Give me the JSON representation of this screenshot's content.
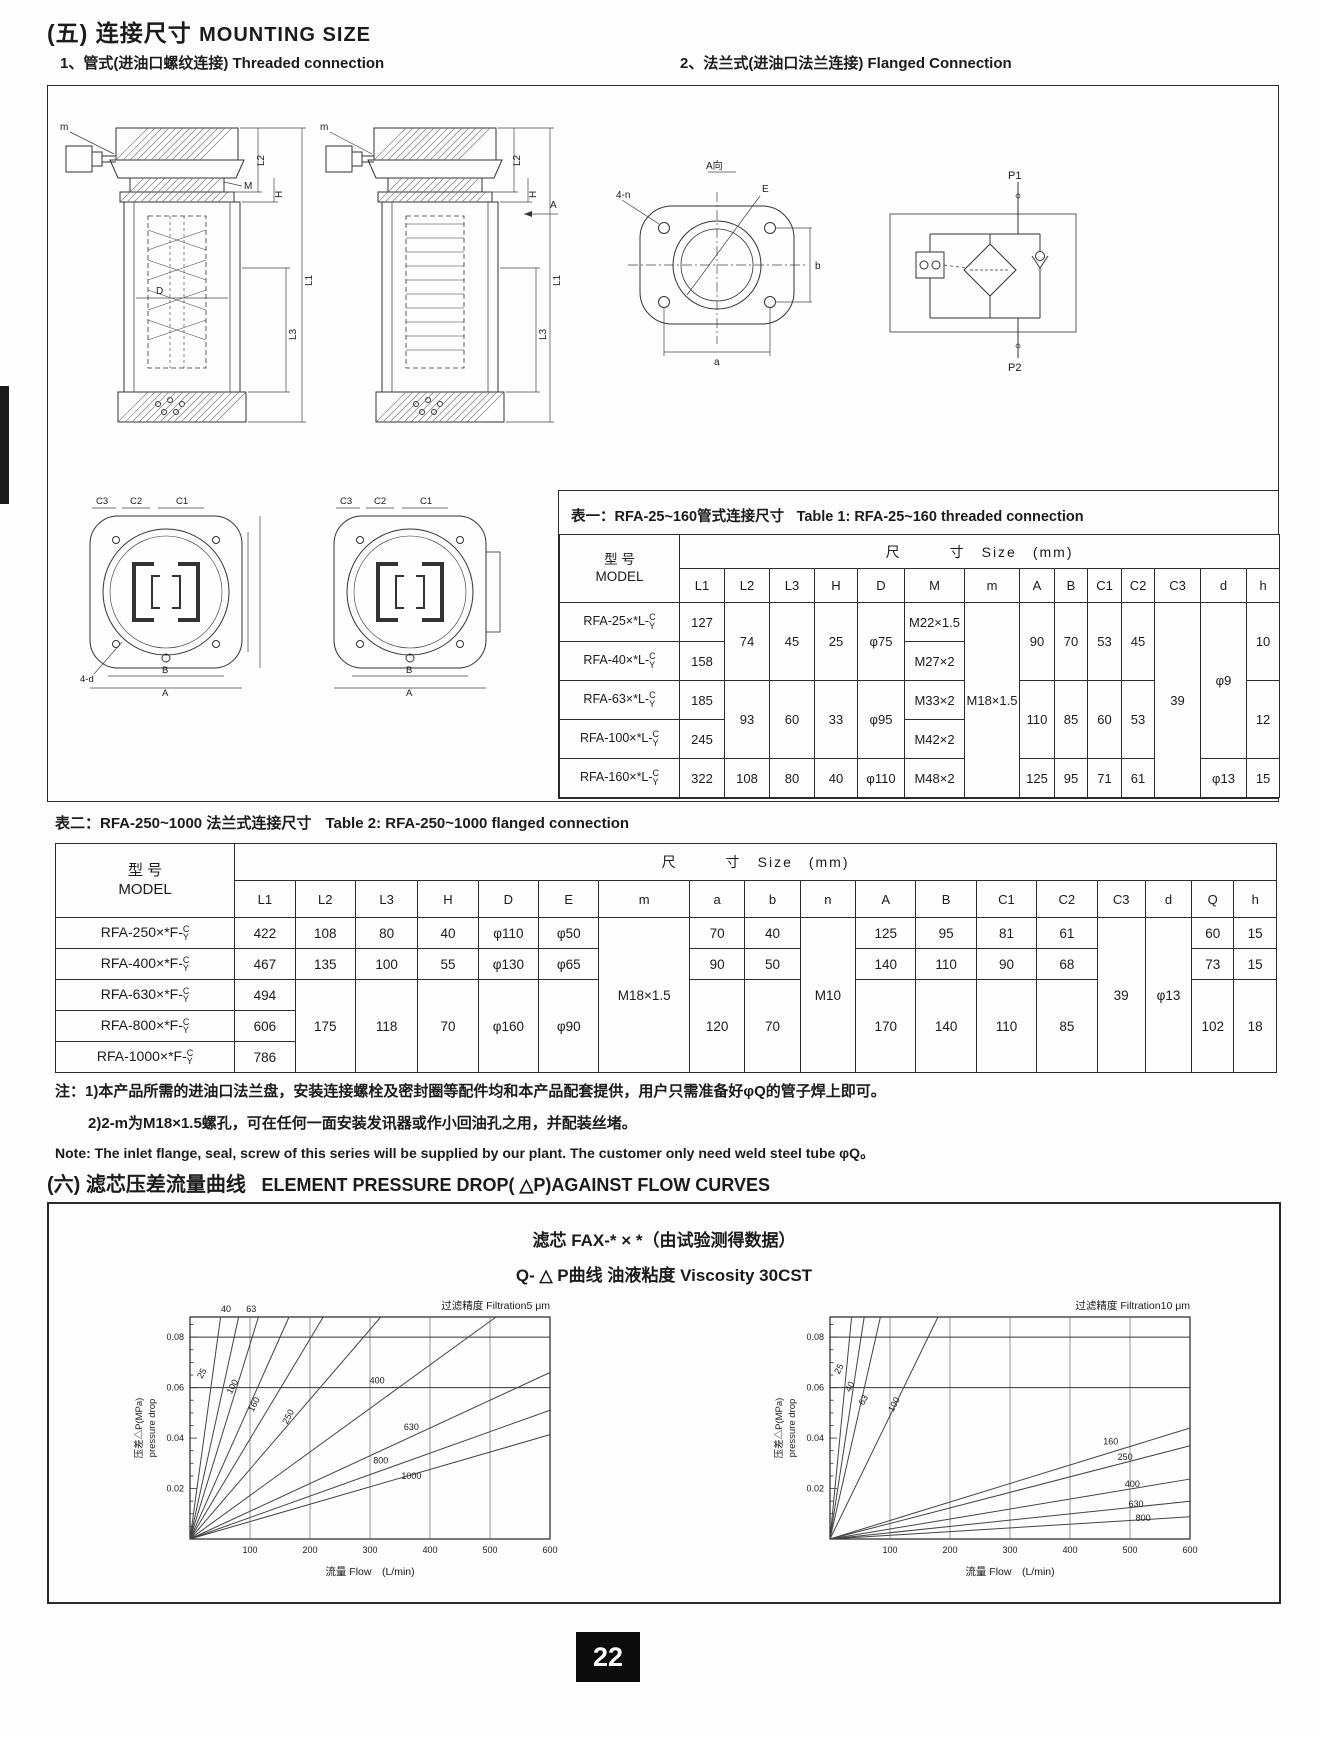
{
  "page": {
    "title_cn": "(五) 连接尺寸",
    "title_en": "MOUNTING SIZE",
    "sub1": "1、管式(进油口螺纹连接)  Threaded connection",
    "sub2": "2、法兰式(进油口法兰连接)   Flanged Connection",
    "page_number": "22"
  },
  "table1": {
    "title_cn": "表一：RFA-25~160管式连接尺寸",
    "title_en": "Table 1: RFA-25~160 threaded connection",
    "headers": {
      "model_cn": "型  号",
      "model_en": "MODEL",
      "size": "尺　　　寸　Size　(mm)",
      "cols": [
        "L1",
        "L2",
        "L3",
        "H",
        "D",
        "M",
        "m",
        "A",
        "B",
        "C1",
        "C2",
        "C3",
        "d",
        "h"
      ]
    },
    "suffix": {
      "top": "C",
      "bot": "Y"
    },
    "rows": [
      {
        "model": "RFA-25×*L-",
        "l1": "127",
        "l2": "74",
        "l3": "45",
        "h_dim": "25",
        "d": "φ75",
        "M": "M22×1.5",
        "m": "M18×1.5",
        "A": "90",
        "B": "70",
        "c1": "53",
        "c2": "45",
        "c3": "39",
        "d_small": "φ9",
        "h": "10"
      },
      {
        "model": "RFA-40×*L-",
        "l1": "158",
        "M": "M27×2"
      },
      {
        "model": "RFA-63×*L-",
        "l1": "185",
        "l2": "93",
        "l3": "60",
        "h_dim": "33",
        "d": "φ95",
        "M": "M33×2",
        "A": "110",
        "B": "85",
        "c1": "60",
        "c2": "53",
        "h": "12"
      },
      {
        "model": "RFA-100×*L-",
        "l1": "245",
        "M": "M42×2"
      },
      {
        "model": "RFA-160×*L-",
        "l1": "322",
        "l2": "108",
        "l3": "80",
        "h_dim": "40",
        "d": "φ110",
        "M": "M48×2",
        "A": "125",
        "B": "95",
        "c1": "71",
        "c2": "61",
        "d_small": "φ13",
        "h": "15"
      }
    ]
  },
  "table2": {
    "title_cn": "表二：RFA-250~1000 法兰式连接尺寸",
    "title_en": "Table 2: RFA-250~1000 flanged  connection",
    "headers": {
      "model_cn": "型  号",
      "model_en": "MODEL",
      "size": "尺　　　寸　Size　(mm)",
      "cols": [
        "L1",
        "L2",
        "L3",
        "H",
        "D",
        "E",
        "m",
        "a",
        "b",
        "n",
        "A",
        "B",
        "C1",
        "C2",
        "C3",
        "d",
        "Q",
        "h"
      ]
    },
    "suffix": {
      "top": "C",
      "bot": "Y"
    },
    "rows": [
      {
        "model": "RFA-250×*F-",
        "l1": "422",
        "l2": "108",
        "l3": "80",
        "h_dim": "40",
        "d": "φ110",
        "e": "φ50",
        "m": "M18×1.5",
        "a": "70",
        "b": "40",
        "n": "M10",
        "A": "125",
        "B": "95",
        "c1": "81",
        "c2": "61",
        "c3": "39",
        "d_small": "φ13",
        "q": "60",
        "h": "15"
      },
      {
        "model": "RFA-400×*F-",
        "l1": "467",
        "l2": "135",
        "l3": "100",
        "h_dim": "55",
        "d": "φ130",
        "e": "φ65",
        "a": "90",
        "b": "50",
        "A": "140",
        "B": "110",
        "c1": "90",
        "c2": "68",
        "q": "73",
        "h": "15"
      },
      {
        "model": "RFA-630×*F-",
        "l1": "494",
        "l2": "175",
        "l3": "118",
        "h_dim": "70",
        "d": "φ160",
        "e": "φ90",
        "a": "120",
        "b": "70",
        "A": "170",
        "B": "140",
        "c1": "110",
        "c2": "85",
        "q": "102",
        "h": "18"
      },
      {
        "model": "RFA-800×*F-",
        "l1": "606"
      },
      {
        "model": "RFA-1000×*F-",
        "l1": "786"
      }
    ]
  },
  "notes": {
    "line1": "注：1)本产品所需的进油口法兰盘，安装连接螺栓及密封圈等配件均和本产品配套提供，用户只需准备好φQ的管子焊上即可。",
    "line2": "2)2-m为M18×1.5螺孔，可在任何一面安装发讯器或作小回油孔之用，并配装丝堵。",
    "line3": "Note: The inlet flange, seal, screw of this series will be supplied by our plant. The customer only need weld steel tube φQ。"
  },
  "section6": {
    "cn": "(六) 滤芯压差流量曲线",
    "en": "ELEMENT PRESSURE DROP( △P)AGAINST FLOW CURVES"
  },
  "charts": {
    "header1": "滤芯 FAX-* × *（由试验测得数据）",
    "header2": "Q- △ P曲线 油液粘度 Viscosity 30CST",
    "left": {
      "filtration_label": "过滤精度 Filtration5 μm",
      "ylabel_cn": "压差△P(MPa)",
      "ylabel_en": "pressure drop",
      "xlabel": "流量 Flow　(L/min)",
      "yticks": [
        "0.02",
        "0.04",
        "0.06",
        "0.08"
      ],
      "xticks": [
        "100",
        "200",
        "300",
        "400",
        "500",
        "600"
      ],
      "top_labels": [
        {
          "text": "40",
          "fx": 0.1
        },
        {
          "text": "63",
          "fx": 0.17
        }
      ],
      "curves": [
        {
          "label": "25",
          "end": [
            0.085,
            1
          ],
          "label_pos": [
            0.04,
            0.74
          ],
          "rotate": true
        },
        {
          "label": "40",
          "end": [
            0.135,
            1
          ],
          "hide_label": true
        },
        {
          "label": "63",
          "end": [
            0.19,
            1
          ],
          "hide_label": true
        },
        {
          "label": "100",
          "end": [
            0.275,
            1
          ],
          "label_pos": [
            0.125,
            0.68
          ],
          "rotate": true
        },
        {
          "label": "160",
          "end": [
            0.37,
            1
          ],
          "label_pos": [
            0.185,
            0.6
          ],
          "rotate": true
        },
        {
          "label": "250",
          "end": [
            0.53,
            1
          ],
          "label_pos": [
            0.28,
            0.545
          ],
          "rotate": true
        },
        {
          "label": "400",
          "end": [
            0.85,
            1
          ],
          "label_pos": [
            0.52,
            0.7
          ]
        },
        {
          "label": "630",
          "end": [
            1,
            0.75
          ],
          "label_pos": [
            0.615,
            0.49
          ]
        },
        {
          "label": "800",
          "end": [
            1,
            0.58
          ],
          "label_pos": [
            0.53,
            0.34
          ]
        },
        {
          "label": "1000",
          "end": [
            1,
            0.47
          ],
          "label_pos": [
            0.615,
            0.27
          ]
        }
      ]
    },
    "right": {
      "filtration_label": "过滤精度 Filtration10 μm",
      "ylabel_cn": "压差△P(MPa)",
      "ylabel_en": "pressure drop",
      "xlabel": "流量 Flow　(L/min)",
      "yticks": [
        "0.02",
        "0.04",
        "0.06",
        "0.08"
      ],
      "xticks": [
        "100",
        "200",
        "300",
        "400",
        "500",
        "600"
      ],
      "top_labels": [],
      "curves": [
        {
          "label": "25",
          "end": [
            0.06,
            1
          ],
          "label_pos": [
            0.032,
            0.76
          ],
          "rotate": true
        },
        {
          "label": "40",
          "end": [
            0.095,
            1
          ],
          "label_pos": [
            0.062,
            0.68
          ],
          "rotate": true
        },
        {
          "label": "63",
          "end": [
            0.14,
            1
          ],
          "label_pos": [
            0.1,
            0.62
          ],
          "rotate": true
        },
        {
          "label": "100",
          "end": [
            0.3,
            1
          ],
          "label_pos": [
            0.185,
            0.6
          ],
          "rotate": true
        },
        {
          "label": "160",
          "end": [
            1,
            0.5
          ],
          "label_pos": [
            0.78,
            0.425
          ]
        },
        {
          "label": "250",
          "end": [
            1,
            0.42
          ],
          "label_pos": [
            0.82,
            0.355
          ]
        },
        {
          "label": "400",
          "end": [
            1,
            0.27
          ],
          "label_pos": [
            0.84,
            0.235
          ]
        },
        {
          "label": "630",
          "end": [
            1,
            0.17
          ],
          "label_pos": [
            0.85,
            0.145
          ]
        },
        {
          "label": "800",
          "end": [
            1,
            0.1
          ],
          "label_pos": [
            0.87,
            0.08
          ]
        }
      ]
    }
  },
  "drawings": {
    "d1": {
      "m": "m",
      "M": "M",
      "H": "H",
      "L2": "L2",
      "D": "D",
      "L1": "L1",
      "L3": "L3"
    },
    "d2": {
      "m": "m",
      "A": "A",
      "L2": "L2",
      "H": "H",
      "L1": "L1",
      "L3": "L3"
    },
    "bv1": {
      "c3": "C3",
      "c2": "C2",
      "c1": "C1",
      "B": "B",
      "A": "A",
      "holes": "4-d"
    },
    "bv2": {
      "c3": "C3",
      "c2": "C2",
      "c1": "C1",
      "B": "B",
      "A": "A"
    },
    "flange": {
      "view": "A向",
      "holes": "4-n",
      "E": "E",
      "b": "b",
      "a": "a"
    },
    "schematic": {
      "p1": "P1",
      "p2": "P2"
    }
  }
}
